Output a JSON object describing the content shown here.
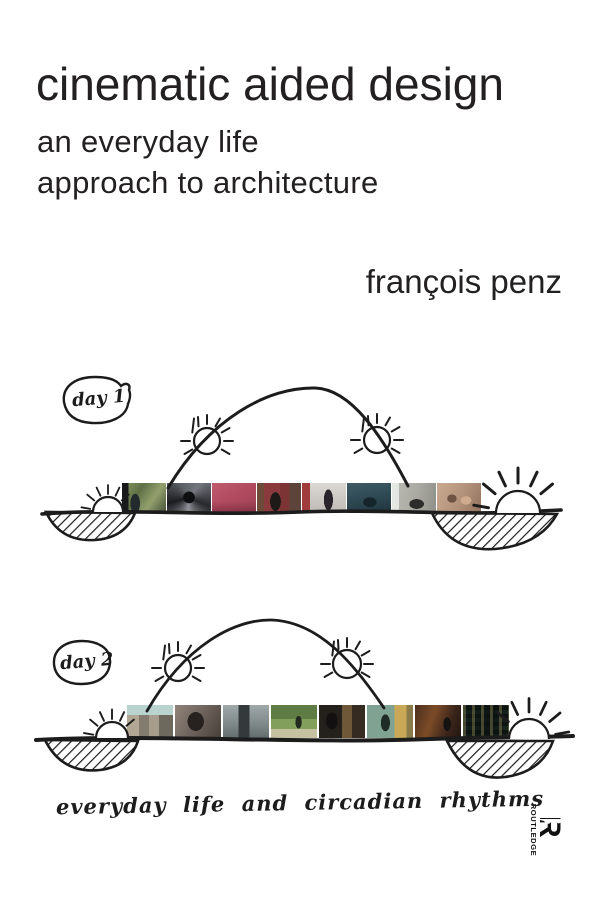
{
  "cover": {
    "title": "cinematic aided design",
    "subtitle_line1": "an everyday life",
    "subtitle_line2": "approach to architecture",
    "author": "françois penz",
    "caption": "everyday life and circadian rhythms",
    "publisher": {
      "name": "ROUTLEDGE",
      "logo_letter": "R"
    },
    "colors": {
      "background": "#ffffff",
      "ink": "#1c1c1c",
      "text": "#232021"
    },
    "day1": {
      "label": "day 1",
      "frames": [
        {
          "name": "window-foliage",
          "bg": "linear-gradient(90deg,#17191b 0 15%,rgba(0,0,0,0) 15%),radial-gradient(ellipse 7px 14px at 30% 68%,#222a2e 68%,rgba(0,0,0,0) 70%),linear-gradient(125deg,#8a9a66 0%,#5f7046 35%,#93a06c 65%,#46503a 100%)"
        },
        {
          "name": "spiral-staircase",
          "bg": "radial-gradient(circle 6px at 50% 48%,#0e0f11 95%,rgba(0,0,0,0) 100%),conic-gradient(from 40deg at 50% 50%,#74767e,#26282c,#8f9298,#1b1d21,#5d6066,#74767e)"
        },
        {
          "name": "pink-room",
          "bg": "linear-gradient(rgba(0,0,0,0) 62%,rgba(70,20,32,0.35)),linear-gradient(150deg,#c05a6c 0%,#b04a5f 50%,#9c4054 100%)"
        },
        {
          "name": "red-kitchen-shelves",
          "bg": "radial-gradient(ellipse 8px 14px at 42% 62%,#1d1a18 66%,rgba(0,0,0,0) 68%),linear-gradient(90deg,#6e4a38 0 16%,#8a3a3c 16% 52%,#7c3434 52% 74%,#5c443a 74%)"
        },
        {
          "name": "white-room-red-door",
          "bg": "linear-gradient(90deg,#a03c3c 0 18%,rgba(0,0,0,0) 18%),radial-gradient(ellipse 7px 16px at 60% 56%,#29242c 64%,rgba(0,0,0,0) 66%),linear-gradient(#dcd9d4,#bdb9b4)"
        },
        {
          "name": "teal-dining-room",
          "bg": "radial-gradient(ellipse 11px 8px at 52% 64%,#15252b 60%,rgba(0,0,0,0) 62%),linear-gradient(170deg,#3e5c66 0%,#2d4751 55%,#1e333d 100%)"
        },
        {
          "name": "grey-living-room",
          "bg": "linear-gradient(90deg,rgba(232,236,232,0.9) 0 16%,rgba(0,0,0,0) 16%),radial-gradient(ellipse 12px 8px at 56% 70%,#2c2c2a 60%,rgba(0,0,0,0) 62%),linear-gradient(100deg,#bcbab3 0%,#a9a9a2 55%,#90908a 100%)"
        },
        {
          "name": "bedroom-couple",
          "bg": "radial-gradient(ellipse 8px 7px at 34% 52%,#6e5244 58%,rgba(0,0,0,0) 60%),radial-gradient(ellipse 9px 7px at 66% 58%,#d0ab90 58%,rgba(0,0,0,0) 60%),linear-gradient(115deg,#c9aa90 0%,#b2917a 55%,#93725e 100%)"
        }
      ]
    },
    "day2": {
      "label": "day 2",
      "frames": [
        {
          "name": "street-facades",
          "bg": "linear-gradient(#b9d3cf 0 30%,rgba(0,0,0,0) 30%),linear-gradient(90deg,#b2a795 0 26%,#837c6e 26% 48%,#a79d8c 48% 70%,#6e695d 70%)"
        },
        {
          "name": "dark-face-closeup",
          "bg": "radial-gradient(ellipse 13px 15px at 45% 50%,#272220 62%,rgba(0,0,0,0) 64%),linear-gradient(120deg,#90847a 0%,#6e635c 50%,#473f39 100%)"
        },
        {
          "name": "building-entrance",
          "bg": "linear-gradient(90deg,rgba(0,0,0,0) 0 34%,#343a3c 34% 58%,rgba(0,0,0,0) 58%),linear-gradient(#a0a8a8 0%,#7e8888 60%,#636c6c 100%)"
        },
        {
          "name": "park-walk",
          "bg": "radial-gradient(ellipse 5px 10px at 60% 52%,#232a20 62%,rgba(0,0,0,0) 64%),linear-gradient(#5f7c44 0 42%,#82a05c 42% 72%,#c6c1a0 72%)"
        },
        {
          "name": "dark-kitchen",
          "bg": "radial-gradient(ellipse 9px 13px at 28% 48%,#121010 64%,rgba(0,0,0,0) 66%),linear-gradient(90deg,#24211c 0 50%,#6e5838 50% 72%,#352b20 72%)"
        },
        {
          "name": "hallway-yellow-door",
          "bg": "radial-gradient(ellipse 7px 13px at 40% 54%,#1f2b27 64%,rgba(0,0,0,0) 66%),linear-gradient(90deg,#80a292 0 60%,#c9a957 60% 86%,#8b7b4b 86%)"
        },
        {
          "name": "night-street",
          "bg": "radial-gradient(ellipse 6px 11px at 70% 58%,#161210 62%,rgba(0,0,0,0) 64%),linear-gradient(110deg,#4c2f1d 0%,#7c4b27 38%,#3b251a 72%,#231610 100%)"
        },
        {
          "name": "night-lit-windows",
          "bg": "repeating-linear-gradient(90deg,rgba(222,201,122,0.28) 0 3px,rgba(0,0,0,0) 3px 9px),repeating-linear-gradient(0deg,rgba(0,0,0,0) 0 4px,rgba(10,18,16,0.85) 4px 8px),linear-gradient(100deg,#13201c 0%,#0d1514 60%,#1a2a22 100%)"
        }
      ]
    }
  }
}
